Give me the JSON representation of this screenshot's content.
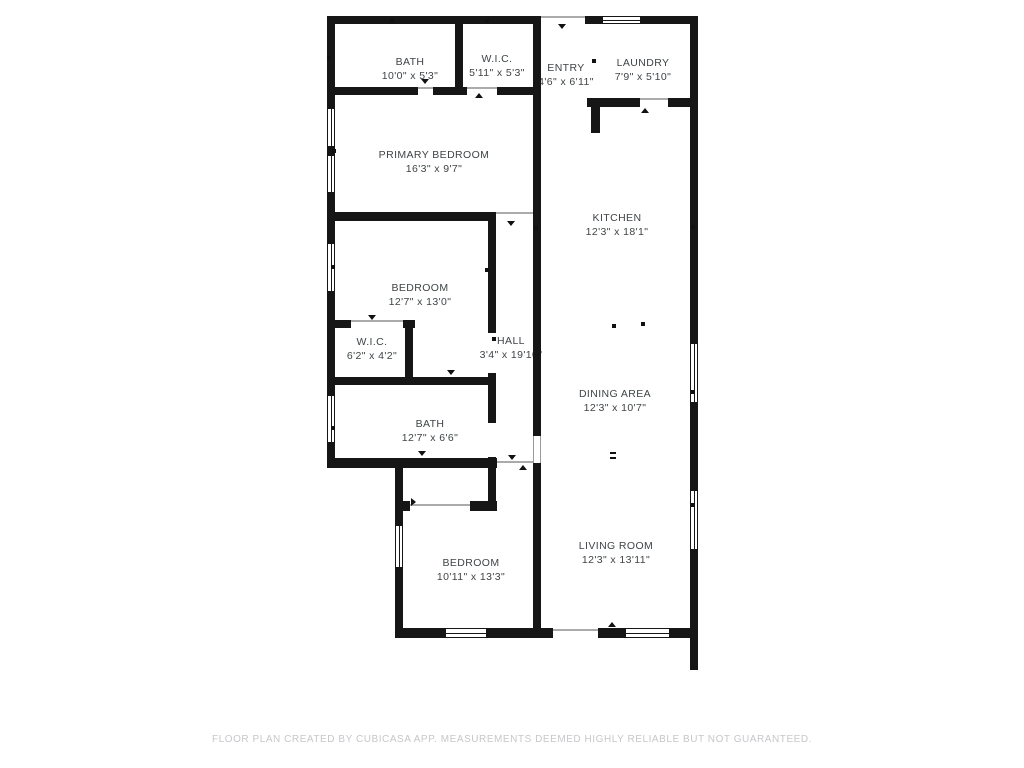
{
  "title": "Floor plan",
  "colors": {
    "wall": "#161616",
    "label_text": "#3f4447",
    "footer_text": "#c7c7cb",
    "background": "#ffffff"
  },
  "rooms": [
    {
      "name": "BATH",
      "dims": "10'0\" x 5'3\""
    },
    {
      "name": "W.I.C.",
      "dims": "5'11\" x 5'3\""
    },
    {
      "name": "ENTRY",
      "dims": "4'6\" x 6'11\""
    },
    {
      "name": "LAUNDRY",
      "dims": "7'9\" x 5'10\""
    },
    {
      "name": "PRIMARY BEDROOM",
      "dims": "16'3\" x 9'7\""
    },
    {
      "name": "KITCHEN",
      "dims": "12'3\" x 18'1\""
    },
    {
      "name": "BEDROOM",
      "dims": "12'7\" x 13'0\""
    },
    {
      "name": "W.I.C.",
      "dims": "6'2\" x 4'2\""
    },
    {
      "name": "HALL",
      "dims": "3'4\" x 19'10\""
    },
    {
      "name": "DINING AREA",
      "dims": "12'3\" x 10'7\""
    },
    {
      "name": "BATH",
      "dims": "12'7\" x 6'6\""
    },
    {
      "name": "BEDROOM",
      "dims": "10'11\" x 13'3\""
    },
    {
      "name": "LIVING ROOM",
      "dims": "12'3\" x 13'11\""
    }
  ],
  "footer": {
    "text": "FLOOR PLAN CREATED BY CUBICASA APP. MEASUREMENTS DEEMED HIGHLY RELIABLE BUT NOT GUARANTEED."
  }
}
